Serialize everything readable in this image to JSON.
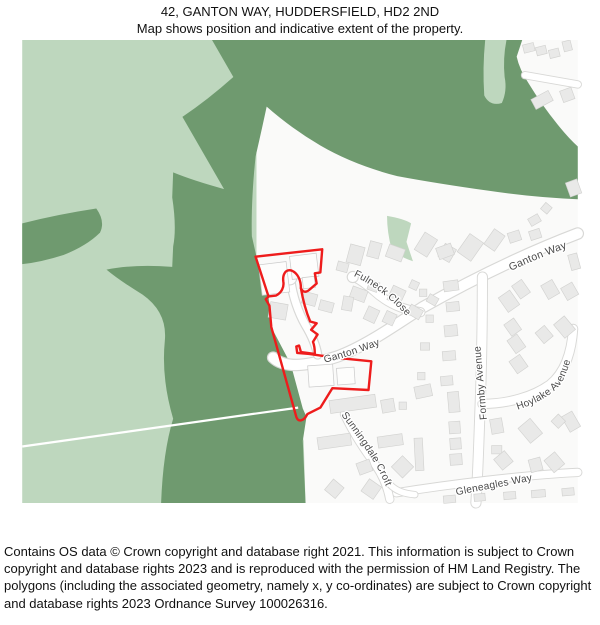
{
  "header": {
    "line1": "42, GANTON WAY, HUDDERSFIELD, HD2 2ND",
    "line2": "Map shows position and indicative extent of the property."
  },
  "map": {
    "street_labels": {
      "fulneck_close": "Fulneck Close",
      "ganton_way_upper": "Ganton Way",
      "ganton_way_mid": "Ganton Way",
      "formby_avenue": "Formby Avenue",
      "hoylake_avenue": "Hoylake Avenue",
      "sunningdale_croft": "Sunningdale Croft",
      "gleneagles_way": "Gleneagles Way"
    },
    "colors": {
      "light_green": "#bed7be",
      "dark_green": "#6f9a6f",
      "base": "#fafaf9",
      "road_fill": "#ffffff",
      "road_casing": "#d8d8d6",
      "building_fill": "#e9e9e8",
      "building_stroke": "#d2d2d0",
      "parcel_stroke": "#cccccc",
      "property_outline": "#ee1c1c",
      "label_color": "#4a4a4a"
    }
  },
  "footer": {
    "text": "Contains OS data © Crown copyright and database right 2021. This information is subject to Crown copyright and database rights 2023 and is reproduced with the permission of HM Land Registry. The polygons (including the associated geometry, namely x, y co-ordinates) are subject to Crown copyright and database rights 2023 Ordnance Survey 100026316."
  }
}
